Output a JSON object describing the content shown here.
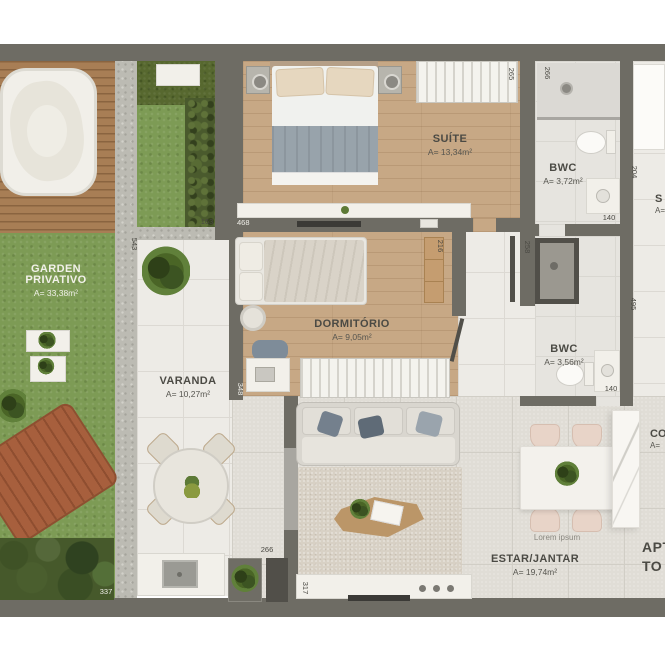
{
  "floorplan": {
    "rooms": {
      "garden": {
        "label": "GARDEN PRIVATIVO",
        "area": "A= 33,38m²"
      },
      "suite": {
        "label": "SUÍTE",
        "area": "A= 13,34m²"
      },
      "bwc_top": {
        "label": "BWC",
        "area": "A= 3,72m²"
      },
      "dormitorio": {
        "label": "DORMITÓRIO",
        "area": "A= 9,05m²"
      },
      "varanda": {
        "label": "VARANDA",
        "area": "A= 10,27m²"
      },
      "bwc_bottom": {
        "label": "BWC",
        "area": "A= 3,56m²"
      },
      "estar_jantar": {
        "label": "ESTAR/JANTAR",
        "area": "A= 19,74m²"
      }
    },
    "partial_labels": {
      "servico": {
        "line1": "S",
        "line2": "A="
      },
      "cozinha": {
        "line1": "CO",
        "line2": "A="
      },
      "apto": {
        "line1": "APT",
        "line2": "TO"
      }
    },
    "annotations": {
      "lorem": "Lorem ipsum"
    },
    "dimensions": {
      "suite_right": "265",
      "bwc_top_left": "266",
      "bwc_top_right": "204",
      "bwc_top_bottom": "140",
      "suite_bottom": "468",
      "inner_garden_width": "163",
      "inner_garden_height": "543",
      "dorm_cabinet": "216",
      "hall_door": "258",
      "dorm_bottom": "348",
      "hall_right": "495",
      "bwc_bottom_width": "140",
      "varanda_counter": "266",
      "garden_bottom": "337",
      "living_bottom": "317"
    },
    "palette": {
      "wall": "#6e6c64",
      "wood_floor": "#c7a885",
      "deck": "#a87e55",
      "grass": "#7d9b55",
      "hedge": "#4a5a2d",
      "tile": "#edebe6",
      "living_tile": "#e0ddd6",
      "lounger": "#a75f3d"
    }
  }
}
